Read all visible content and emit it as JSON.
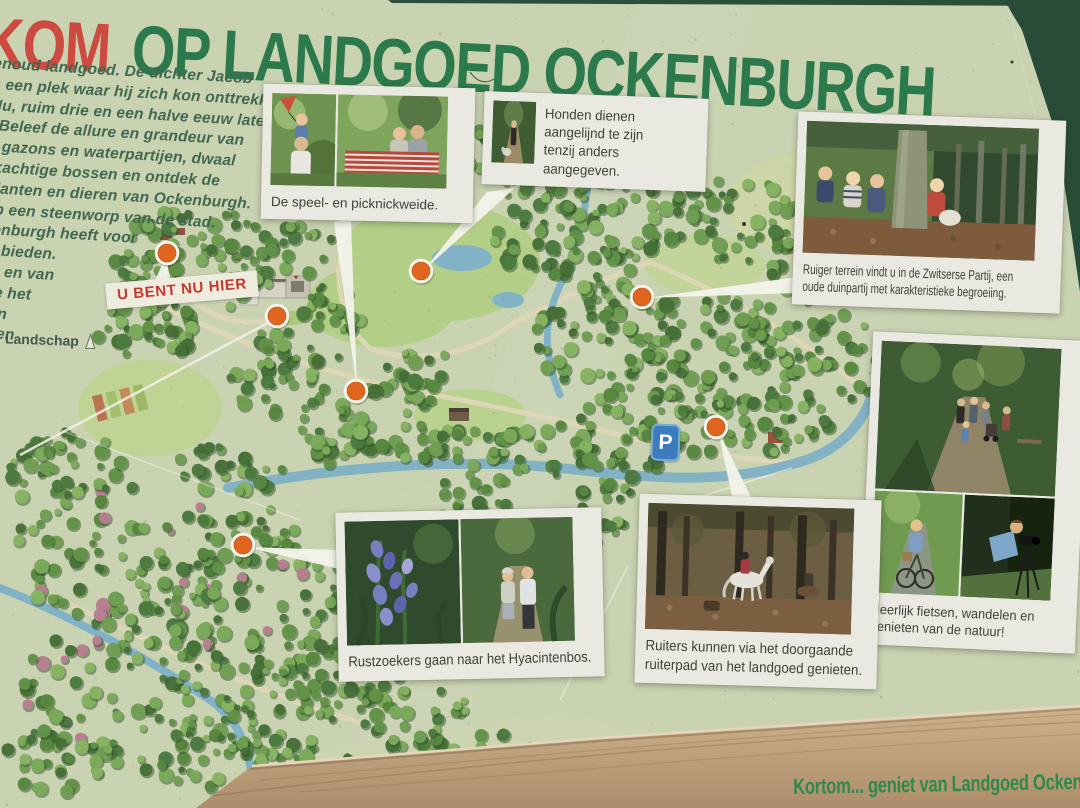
{
  "sign": {
    "title_red": "KOM",
    "title_green": "OP LANDGOED OCKENBURGH",
    "footer": "Kortom... geniet van Landgoed Ockenb",
    "you_are_here": "U BENT NU HIER",
    "logo_text": "Landschap",
    "colors": {
      "title_green": "#2c7a4b",
      "title_red": "#cd4a40",
      "marker_orange": "#e0651f",
      "parking_blue": "#3d7cbc",
      "wood_rail": "#c3a47e",
      "poster_paper": "#c9d3b1"
    }
  },
  "intro_text": {
    "lines": [
      "enoud landgoed. De dichter Jacob",
      "s een plek waar hij zich kon onttrekken",
      "Nu, ruim drie en een halve eeuw later,",
      ". Beleef de allure en grandeur van",
      "e gazons en waterpartijen, dwaal",
      "rkachtige bossen en ontdek de",
      "planten en dieren van Ockenburgh.",
      "op een steenworp van de stad.",
      "kenburgh heeft voor",
      "te bieden.",
      "en en van",
      "Zie het",
      "iten",
      "st en"
    ]
  },
  "cards": {
    "picnic": {
      "caption": "De speel- en picknickweide."
    },
    "dogs": {
      "caption": "Honden dienen\naangelijnd te zijn\ntenzij anders\naangegeven."
    },
    "zwitserse": {
      "caption": "Ruiger terrein vindt u in de Zwitserse Partij, een\noude duinpartij met karakteristieke begroeiing."
    },
    "cycling": {
      "caption": "Heerlijk fietsen, wandelen en\ngenieten van de natuur!"
    },
    "hyacinth": {
      "caption": "Rustzoekers gaan naar het Hyacintenbos."
    },
    "riders": {
      "caption": "Ruiters kunnen via het doorgaande\nruiterpad van het landgoed genieten."
    }
  },
  "map": {
    "parking_label": "P",
    "markers": [
      {
        "id": 1,
        "x": 167,
        "y": 253,
        "links_to": "you_are_here_label"
      },
      {
        "id": 2,
        "x": 277,
        "y": 316,
        "links_to": "intro_text"
      },
      {
        "id": 3,
        "x": 356,
        "y": 391,
        "links_to": "picnic"
      },
      {
        "id": 4,
        "x": 421,
        "y": 271,
        "links_to": "dogs"
      },
      {
        "id": 5,
        "x": 642,
        "y": 297,
        "links_to": "zwitserse"
      },
      {
        "id": 6,
        "x": 716,
        "y": 427,
        "links_to": "riders"
      },
      {
        "id": 7,
        "x": 243,
        "y": 545,
        "links_to": "hyacinth"
      }
    ]
  }
}
